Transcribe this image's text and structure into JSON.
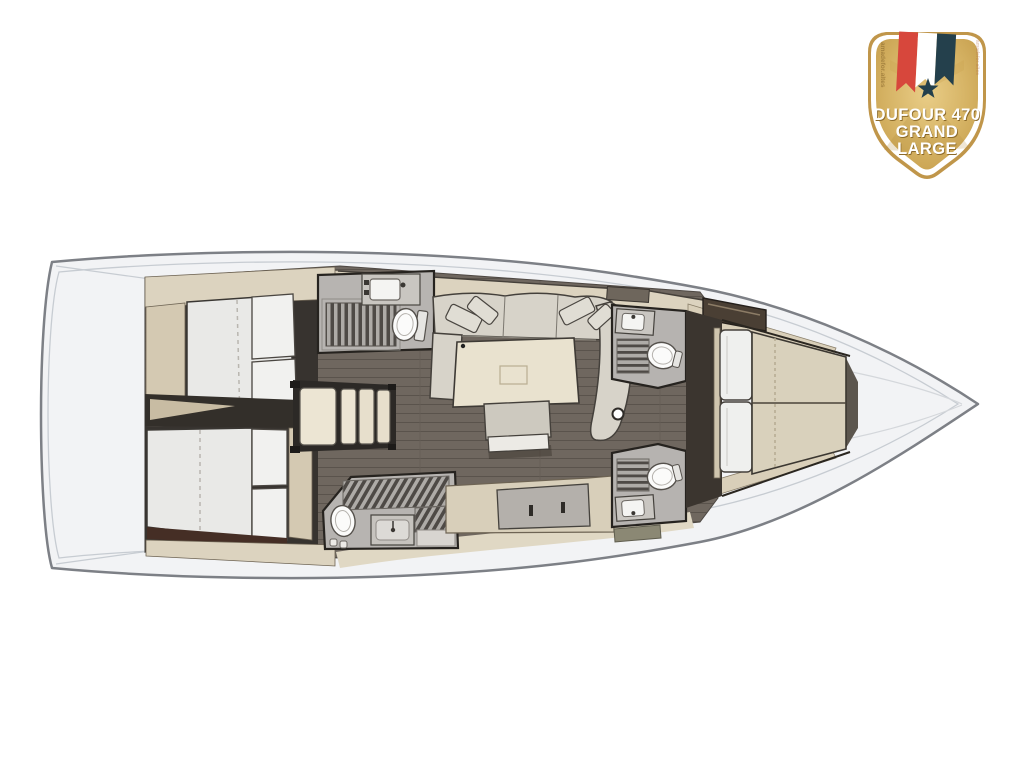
{
  "badge": {
    "line1": "DUFOUR 470",
    "line2": "GRAND",
    "line3": "LARGE",
    "watermark_left": "amadefor.altes",
    "watermark_right": "amadefor.altes",
    "colors": {
      "gold": "#d5b263",
      "gold_border": "#c0964a",
      "ribbon_red": "#d7473c",
      "ribbon_white": "#ffffff",
      "ribbon_navy": "#24404c",
      "star": "#24404c",
      "title_text": "#ffffff"
    }
  },
  "floorplan": {
    "vessel": "Dufour 470 Grand Large",
    "view": "interior deck plan, bow pointing right",
    "colors": {
      "deck_white": "#f2f3f5",
      "hull_outline": "#7d8086",
      "wood_floor": "#6f675f",
      "joinery_beige": "#dcd3bf",
      "upholstery_grey": "#d7d3c9",
      "bathroom_floor": "#b7b4b1",
      "mattress_white": "#e9e9e7",
      "mattress_beige": "#d9d1bc",
      "dark_walls": "#26231f"
    },
    "rooms": [
      "aft cabin port - double berth",
      "aft cabin starboard - double berth",
      "companionway stairs",
      "head with shower (port, amidships)",
      "head with shower (starboard, aft)",
      "saloon with U-sofa, table and bench",
      "galley counter",
      "forward head port",
      "forward head starboard",
      "owner cabin forward - double berth",
      "mast post"
    ]
  }
}
